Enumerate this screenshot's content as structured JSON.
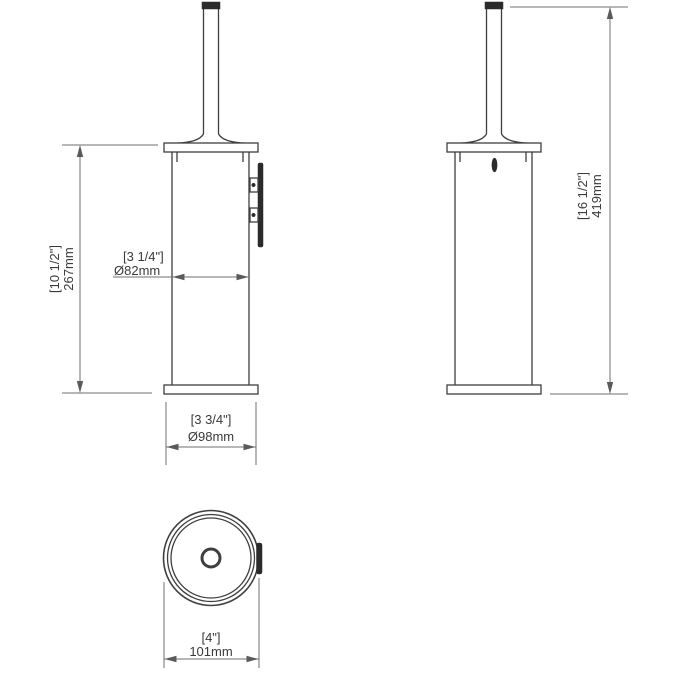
{
  "drawing": {
    "background": "#ffffff",
    "object_line_color": "#3f3f3f",
    "dimension_line_color": "#6f6f6f",
    "text_color": "#3a3a3a",
    "views": {
      "side_wall_mounted": {
        "height_dim": {
          "inches": "[10 1/2\"]",
          "metric": "267mm"
        },
        "body_diameter_dim": {
          "inches": "[3 1/4\"]",
          "metric": "Ø82mm"
        },
        "base_diameter_dim": {
          "inches": "[3 3/4\"]",
          "metric": "Ø98mm"
        }
      },
      "side_freestanding": {
        "overall_height_dim": {
          "inches": "[16 1/2\"]",
          "metric": "419mm"
        }
      },
      "top_view": {
        "overall_width_dim": {
          "inches": "[4\"]",
          "metric": "101mm"
        }
      }
    }
  }
}
